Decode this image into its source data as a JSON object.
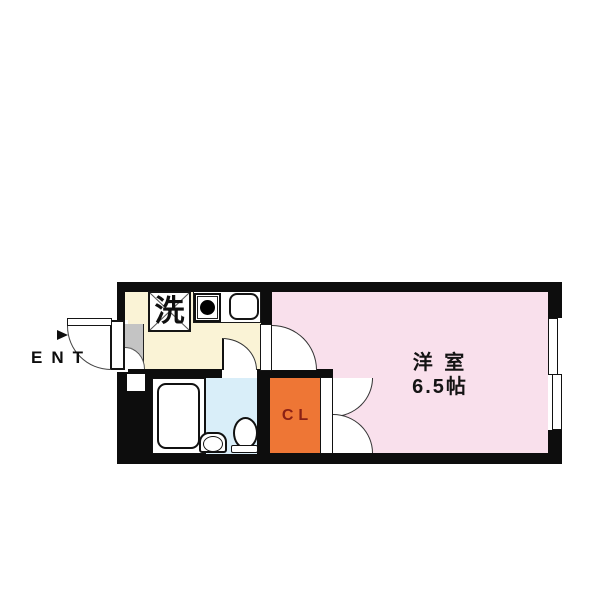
{
  "floorplan": {
    "rooms": {
      "living": {
        "name": "洋 室",
        "size": "6.5帖"
      },
      "closet": {
        "label": "CL"
      },
      "entrance": {
        "label": "ENT"
      }
    },
    "fixtures": {
      "laundry_label": "洗"
    },
    "colors": {
      "room_pink": "#f9e0ec",
      "kitchen_cream": "#faf3d6",
      "bath_blue": "#d9eef9",
      "closet_orange": "#ee7635",
      "closet_label_red": "#8b2015",
      "entry_gray": "#c4c4c4",
      "wall_black": "#0d0d0d"
    }
  }
}
